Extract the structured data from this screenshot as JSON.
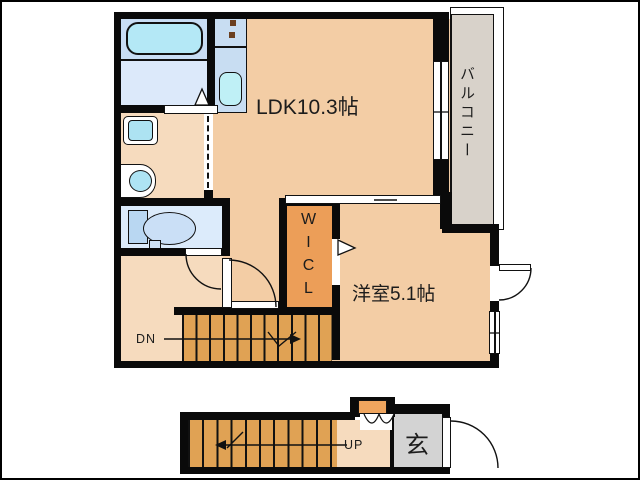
{
  "rooms": {
    "ldk": {
      "label": "LDK10.3帖"
    },
    "western_room": {
      "label": "洋室5.1帖"
    },
    "balcony": {
      "label": "バルコニー"
    },
    "walk_in_closet": {
      "label": "WICL"
    },
    "entrance": {
      "label": "玄"
    }
  },
  "stairs": {
    "down_label": "DN",
    "up_label": "UP"
  },
  "colors": {
    "wall": "#0a0a0a",
    "floor_main": "#f3cda5",
    "floor_hall": "#f6dbbe",
    "closet_orange": "#ec9e58",
    "stair_orange": "#e0a254",
    "balcony_gray": "#d8d2ca",
    "entrance_gray": "#d3d3d3",
    "wet_area_blue": "#c8ddf4",
    "fixture_cyan": "#b4e8f6"
  }
}
